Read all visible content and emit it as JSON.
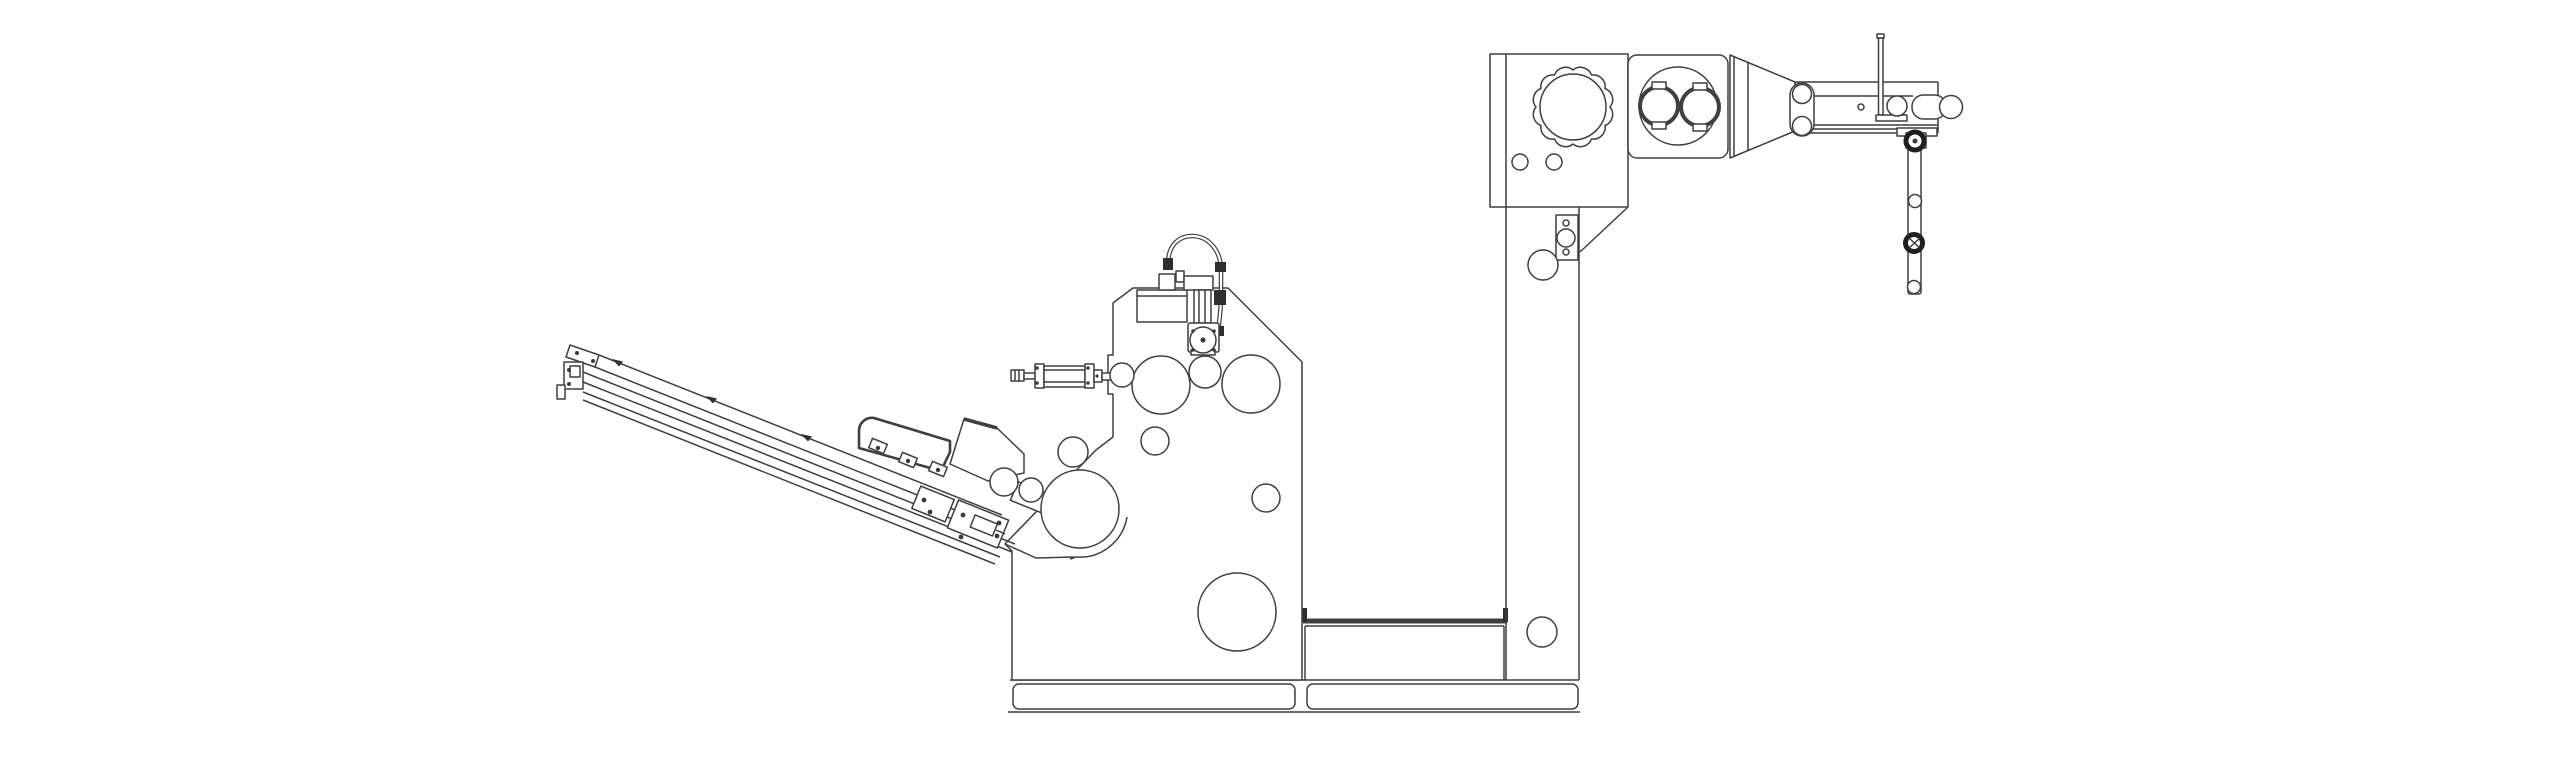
{
  "drawing": {
    "title": "Labeling machine - side elevation technical line drawing",
    "type": "technical-line-drawing",
    "background_color": "#ffffff",
    "line_color": "#3f3f3f",
    "dark_detail_color": "#1f1f1f",
    "parts": [
      {
        "id": "infeed-ramp",
        "label": "Inclined infeed ramp with guide rails"
      },
      {
        "id": "ramp-drive-cover",
        "label": "Ramp drive cover"
      },
      {
        "id": "applicator-head",
        "label": "Label applicator head with peel rollers"
      },
      {
        "id": "pusher-cylinder",
        "label": "Pneumatic pusher cylinder"
      },
      {
        "id": "main-frame",
        "label": "Main frame plate with guide rollers"
      },
      {
        "id": "valve-assembly",
        "label": "Valve, hose and drive motor assembly"
      },
      {
        "id": "machine-base",
        "label": "Machine base plate with foot pads"
      },
      {
        "id": "support-column",
        "label": "Vertical support column"
      },
      {
        "id": "unwind-box",
        "label": "Unwind spindle box with scalloped chuck"
      },
      {
        "id": "nip-roller-box",
        "label": "Nip roller housing with twin rollers"
      },
      {
        "id": "support-arm",
        "label": "Overhead support arm with guide rollers"
      },
      {
        "id": "dancer-arm",
        "label": "Dancer arm with tension rollers"
      }
    ]
  },
  "circles": {
    "machine": [
      {
        "name": "guide-roller",
        "cx": 1161,
        "cy": 385,
        "r": 29,
        "cls": "c"
      },
      {
        "name": "guide-roller",
        "cx": 1205,
        "cy": 372,
        "r": 16,
        "cls": "c"
      },
      {
        "name": "guide-roller",
        "cx": 1251,
        "cy": 384,
        "r": 29,
        "cls": "c"
      },
      {
        "name": "guide-roller",
        "cx": 1155,
        "cy": 441,
        "r": 14,
        "cls": "c"
      },
      {
        "name": "frame-hole",
        "cx": 1266,
        "cy": 498,
        "r": 14,
        "cls": "c"
      },
      {
        "name": "drive-roller",
        "cx": 1237,
        "cy": 612,
        "r": 39,
        "cls": "c"
      },
      {
        "name": "peel-roller",
        "cx": 1004,
        "cy": 482,
        "r": 14,
        "cls": "c"
      },
      {
        "name": "peel-roller",
        "cx": 1031,
        "cy": 490,
        "r": 12,
        "cls": "c"
      },
      {
        "name": "idler-roller",
        "cx": 1073,
        "cy": 452,
        "r": 15,
        "cls": "c"
      },
      {
        "name": "press-roller",
        "cx": 1080,
        "cy": 509,
        "r": 39,
        "cls": "c"
      },
      {
        "name": "edge-roller",
        "cx": 1122,
        "cy": 375,
        "r": 12,
        "cls": "c"
      }
    ],
    "valve": [
      {
        "name": "motor-flange",
        "cx": 1203,
        "cy": 340,
        "r": 13,
        "cls": "c"
      }
    ],
    "column": [
      {
        "name": "column-hole",
        "cx": 1566,
        "cy": 223,
        "r": 3,
        "cls": "c"
      },
      {
        "name": "bracket-roller",
        "cx": 1566,
        "cy": 238,
        "r": 9,
        "cls": "c"
      },
      {
        "name": "column-hole",
        "cx": 1566,
        "cy": 252,
        "r": 3,
        "cls": "c"
      },
      {
        "name": "column-roller",
        "cx": 1543,
        "cy": 265,
        "r": 15,
        "cls": "c"
      },
      {
        "name": "column-roller",
        "cx": 1542,
        "cy": 632,
        "r": 15,
        "cls": "c"
      }
    ],
    "unwind": [
      {
        "name": "unwind-chuck",
        "cx": 1573,
        "cy": 107,
        "r": 33,
        "cls": "c"
      },
      {
        "name": "panel-hole",
        "cx": 1520,
        "cy": 162,
        "r": 8,
        "cls": "c"
      },
      {
        "name": "panel-hole",
        "cx": 1554,
        "cy": 162,
        "r": 8,
        "cls": "c"
      }
    ],
    "nip": [
      {
        "name": "nip-housing-bore",
        "cx": 1678,
        "cy": 106,
        "r": 39,
        "cls": "c"
      },
      {
        "name": "nip-roller",
        "cx": 1659,
        "cy": 106,
        "r": 19,
        "cls": "thick"
      },
      {
        "name": "nip-roller",
        "cx": 1700,
        "cy": 107,
        "r": 19,
        "cls": "thick"
      }
    ],
    "arm": [
      {
        "name": "arm-roller",
        "cx": 1802,
        "cy": 94,
        "r": 9.5,
        "cls": "c"
      },
      {
        "name": "arm-roller",
        "cx": 1802,
        "cy": 126,
        "r": 9.5,
        "cls": "c"
      },
      {
        "name": "arm-hole",
        "cx": 1861,
        "cy": 107,
        "r": 3,
        "cls": "c"
      },
      {
        "name": "arm-roller",
        "cx": 1897,
        "cy": 106,
        "r": 10,
        "cls": "c"
      },
      {
        "name": "end-roller-cap",
        "cx": 1951,
        "cy": 107,
        "r": 11.5,
        "cls": "c"
      },
      {
        "name": "dancer-pivot-knob",
        "cx": 1915,
        "cy": 141,
        "r": 9,
        "cls": "dark"
      },
      {
        "name": "dancer-pivot-pin",
        "cx": 1915,
        "cy": 141,
        "r": 2.5,
        "cls": "dot"
      },
      {
        "name": "dancer-roller",
        "cx": 1915,
        "cy": 201,
        "r": 6.5,
        "cls": "c"
      },
      {
        "name": "dancer-knob",
        "cx": 1914,
        "cy": 243,
        "r": 8.5,
        "cls": "dark"
      },
      {
        "name": "dancer-roller",
        "cx": 1914,
        "cy": 287,
        "r": 6.5,
        "cls": "c"
      }
    ],
    "screws": [
      {
        "name": "screw",
        "cx": 577,
        "cy": 353,
        "r": 2,
        "cls": "dot"
      },
      {
        "name": "screw",
        "cx": 593,
        "cy": 361,
        "r": 2,
        "cls": "dot"
      },
      {
        "name": "screw",
        "cx": 569,
        "cy": 370,
        "r": 2,
        "cls": "dot"
      },
      {
        "name": "screw",
        "cx": 569,
        "cy": 384,
        "r": 2,
        "cls": "dot"
      },
      {
        "name": "screw",
        "cx": 878,
        "cy": 448,
        "r": 2.2,
        "cls": "dot"
      },
      {
        "name": "screw",
        "cx": 908,
        "cy": 461,
        "r": 2.2,
        "cls": "dot"
      },
      {
        "name": "screw",
        "cx": 938,
        "cy": 470,
        "r": 2.2,
        "cls": "dot"
      },
      {
        "name": "screw",
        "cx": 924,
        "cy": 500,
        "r": 2.4,
        "cls": "dot"
      },
      {
        "name": "screw",
        "cx": 930,
        "cy": 512,
        "r": 2.4,
        "cls": "dot"
      },
      {
        "name": "screw",
        "cx": 963,
        "cy": 515,
        "r": 2.4,
        "cls": "dot"
      },
      {
        "name": "screw",
        "cx": 999,
        "cy": 523,
        "r": 2.4,
        "cls": "dot"
      },
      {
        "name": "screw",
        "cx": 961,
        "cy": 537,
        "r": 2.4,
        "cls": "dot"
      },
      {
        "name": "screw",
        "cx": 997,
        "cy": 536,
        "r": 2.4,
        "cls": "dot"
      },
      {
        "name": "flange-bolt",
        "cx": 1193,
        "cy": 331,
        "r": 1.8,
        "cls": "dot"
      },
      {
        "name": "flange-bolt",
        "cx": 1214,
        "cy": 331,
        "r": 1.8,
        "cls": "dot"
      },
      {
        "name": "flange-bolt",
        "cx": 1193,
        "cy": 350,
        "r": 1.8,
        "cls": "dot"
      },
      {
        "name": "flange-bolt",
        "cx": 1214,
        "cy": 350,
        "r": 1.8,
        "cls": "dot"
      },
      {
        "name": "flange-center",
        "cx": 1203,
        "cy": 340,
        "r": 2.6,
        "cls": "dot"
      },
      {
        "name": "clevis-pin",
        "cx": 1097,
        "cy": 376,
        "r": 1.6,
        "cls": "dot"
      },
      {
        "name": "tie-rod-nut",
        "cx": 1037,
        "cy": 368,
        "r": 1.8,
        "cls": "dot"
      },
      {
        "name": "tie-rod-nut",
        "cx": 1037,
        "cy": 383,
        "r": 1.8,
        "cls": "dot"
      },
      {
        "name": "tie-rod-nut",
        "cx": 1088,
        "cy": 368,
        "r": 1.8,
        "cls": "dot"
      },
      {
        "name": "tie-rod-nut",
        "cx": 1088,
        "cy": 383,
        "r": 1.8,
        "cls": "dot"
      }
    ]
  }
}
